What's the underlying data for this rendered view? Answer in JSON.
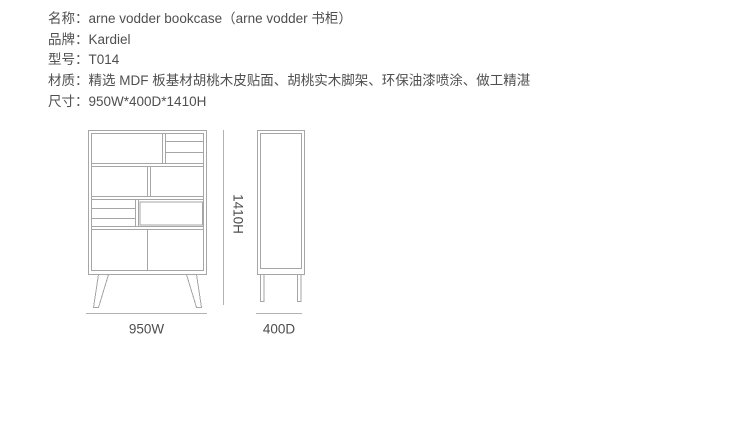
{
  "spec": {
    "rows": [
      {
        "label": "名称：",
        "value": "arne vodder bookcase（arne vodder 书柜）"
      },
      {
        "label": "品牌：",
        "value": "Kardiel"
      },
      {
        "label": "型号：",
        "value": "T014"
      },
      {
        "label": "材质：",
        "value": "精选 MDF 板基材胡桃木皮贴面、胡桃实木脚架、环保油漆喷涂、做工精湛"
      },
      {
        "label": "尺寸：",
        "value": "950W*400D*1410H"
      }
    ]
  },
  "drawing": {
    "front_view": {
      "width_label": "950W",
      "height_label": "1410H"
    },
    "side_view": {
      "depth_label": "400D"
    }
  },
  "colors": {
    "background": "#ffffff",
    "text": "#4f4f4f",
    "drawing_line": "#a6a6a6",
    "dimension_line": "#b2b2b2"
  }
}
